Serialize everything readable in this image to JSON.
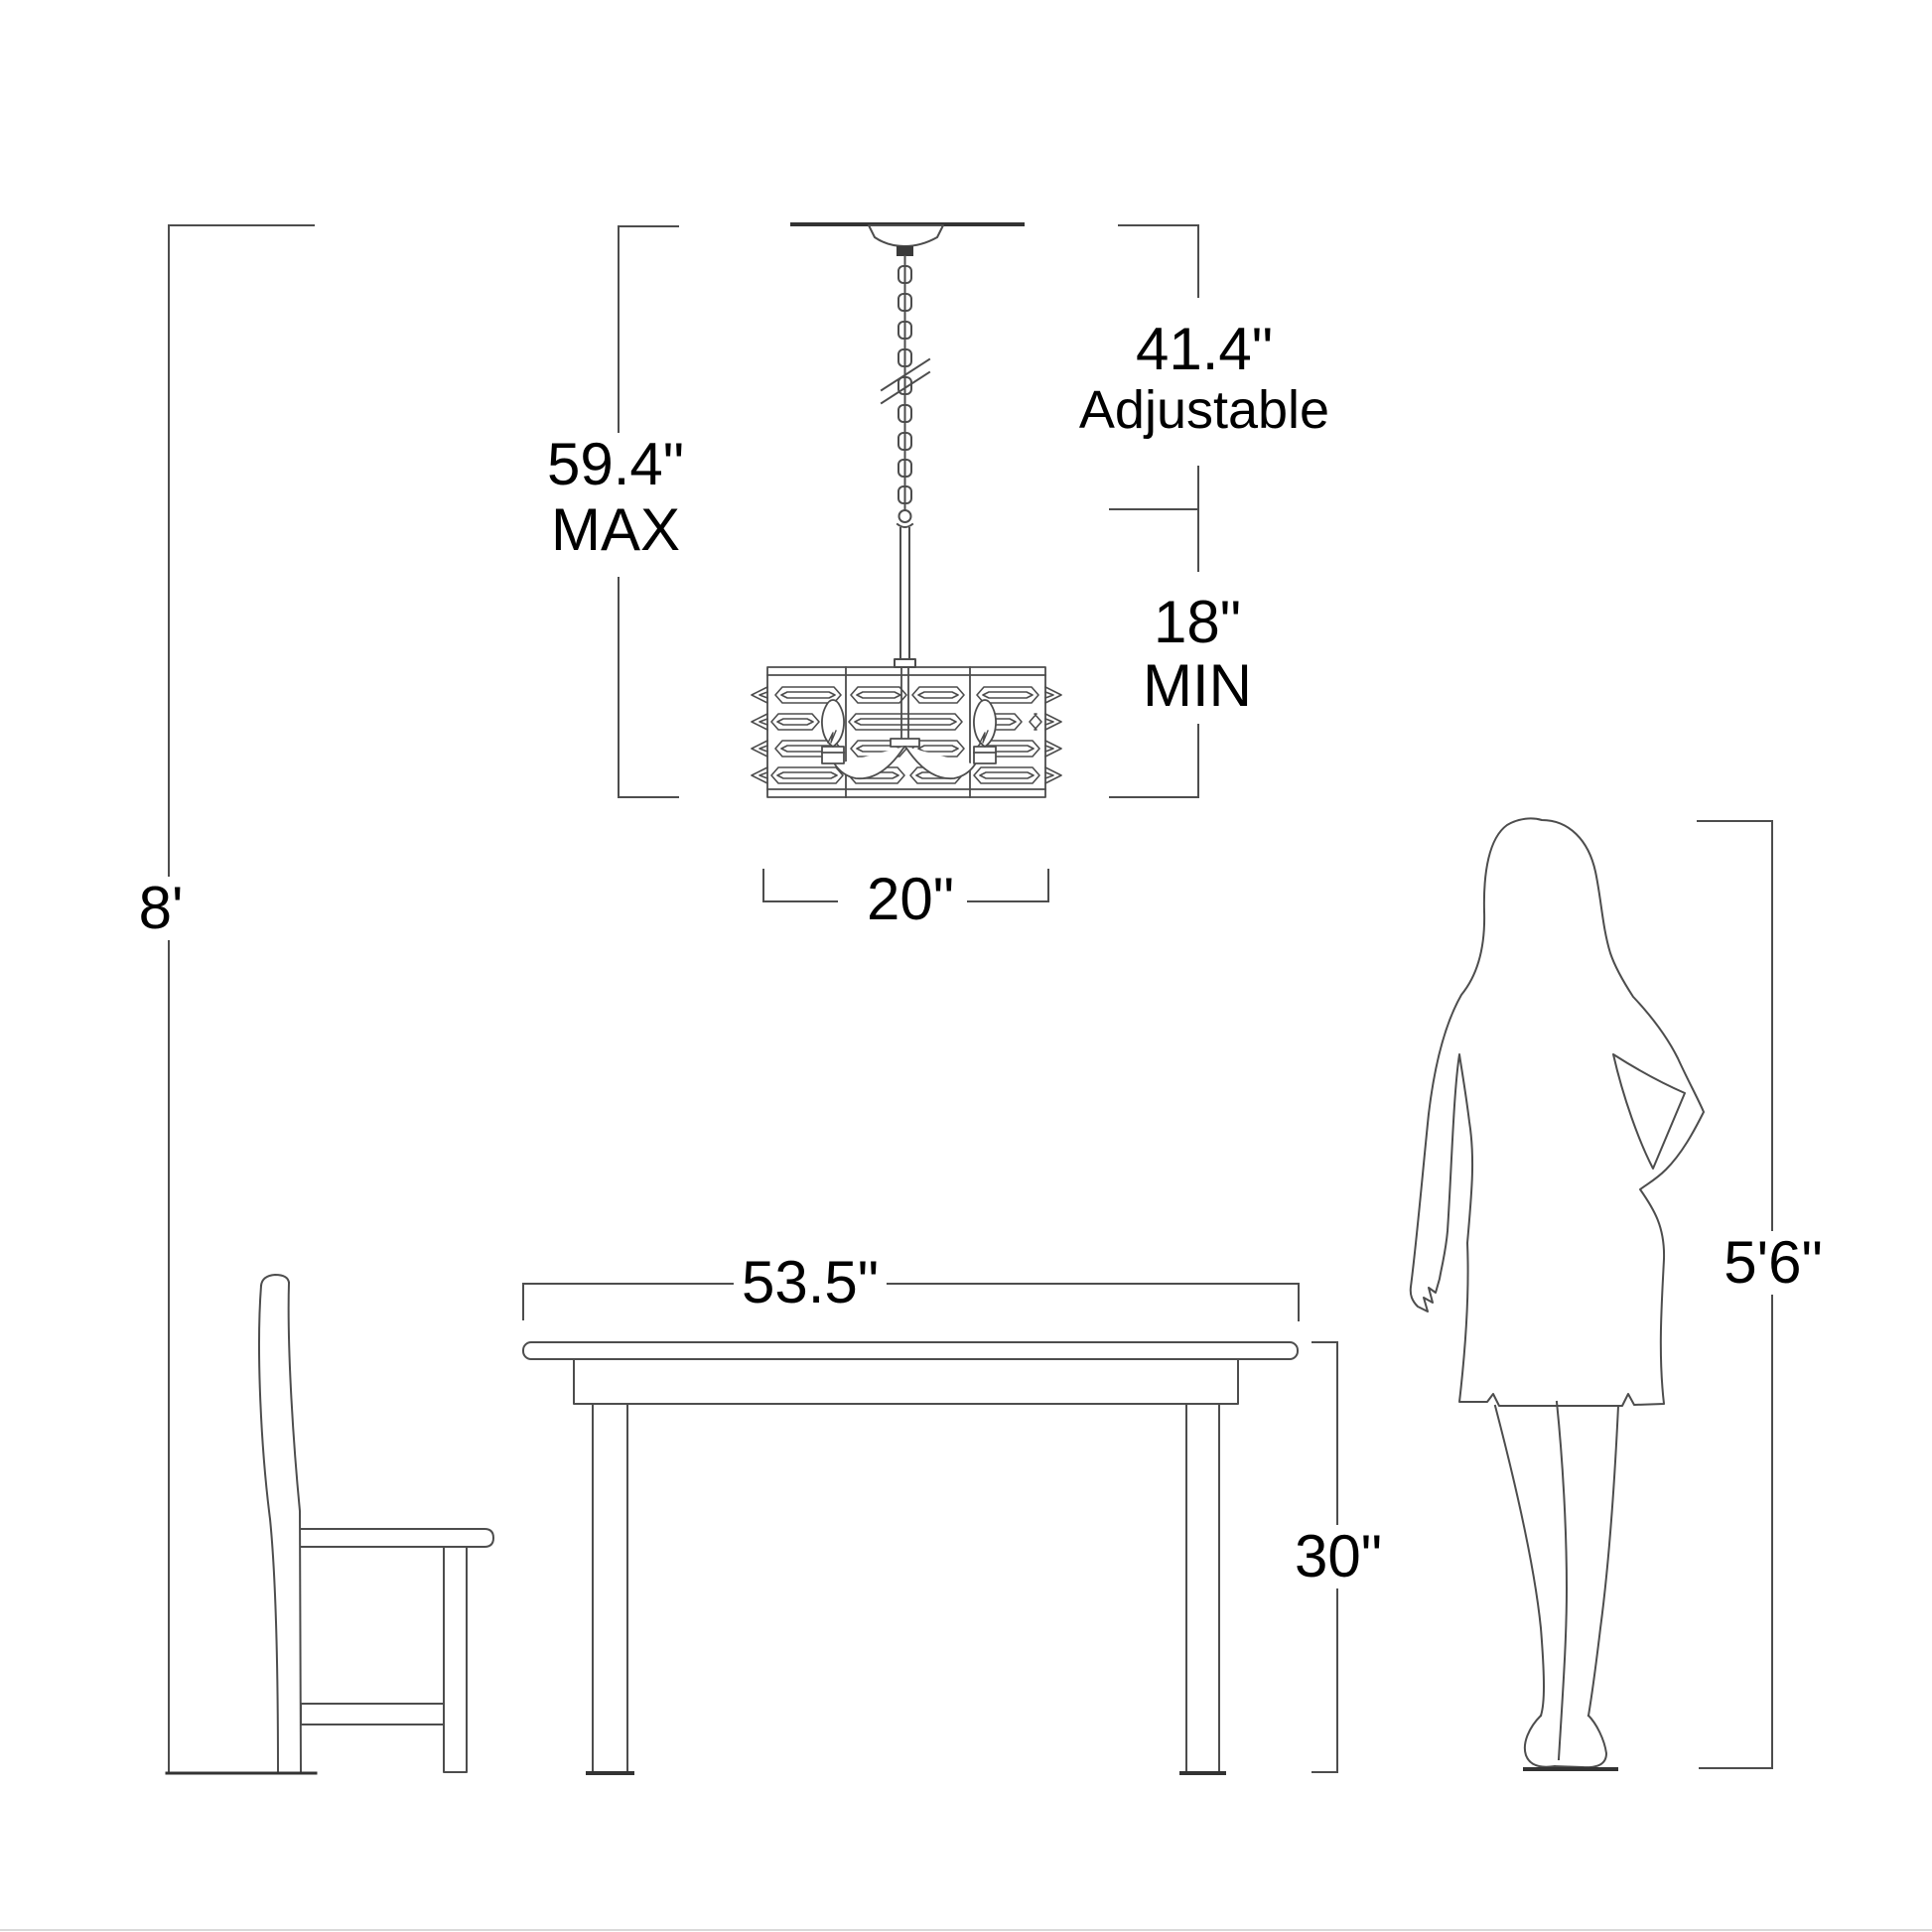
{
  "diagram": {
    "type": "product-dimension-line-drawing",
    "scene": [
      "ceiling",
      "chandelier-pendant",
      "dining-table",
      "side-chair",
      "woman-silhouette"
    ],
    "colors": {
      "background": "#ffffff",
      "line": "#4d4d4d",
      "heavy_line": "#333333",
      "text": "#000000"
    },
    "labels": {
      "ceiling_height": "8'",
      "fixture_max": "59.4\"",
      "fixture_max_qualifier": "MAX",
      "chain_adjustable": "41.4\"",
      "chain_adjustable_qualifier": "Adjustable",
      "fixture_min": "18\"",
      "fixture_min_qualifier": "MIN",
      "fixture_width": "20\"",
      "table_width": "53.5\"",
      "table_height": "30\"",
      "person_height": "5'6\""
    }
  }
}
